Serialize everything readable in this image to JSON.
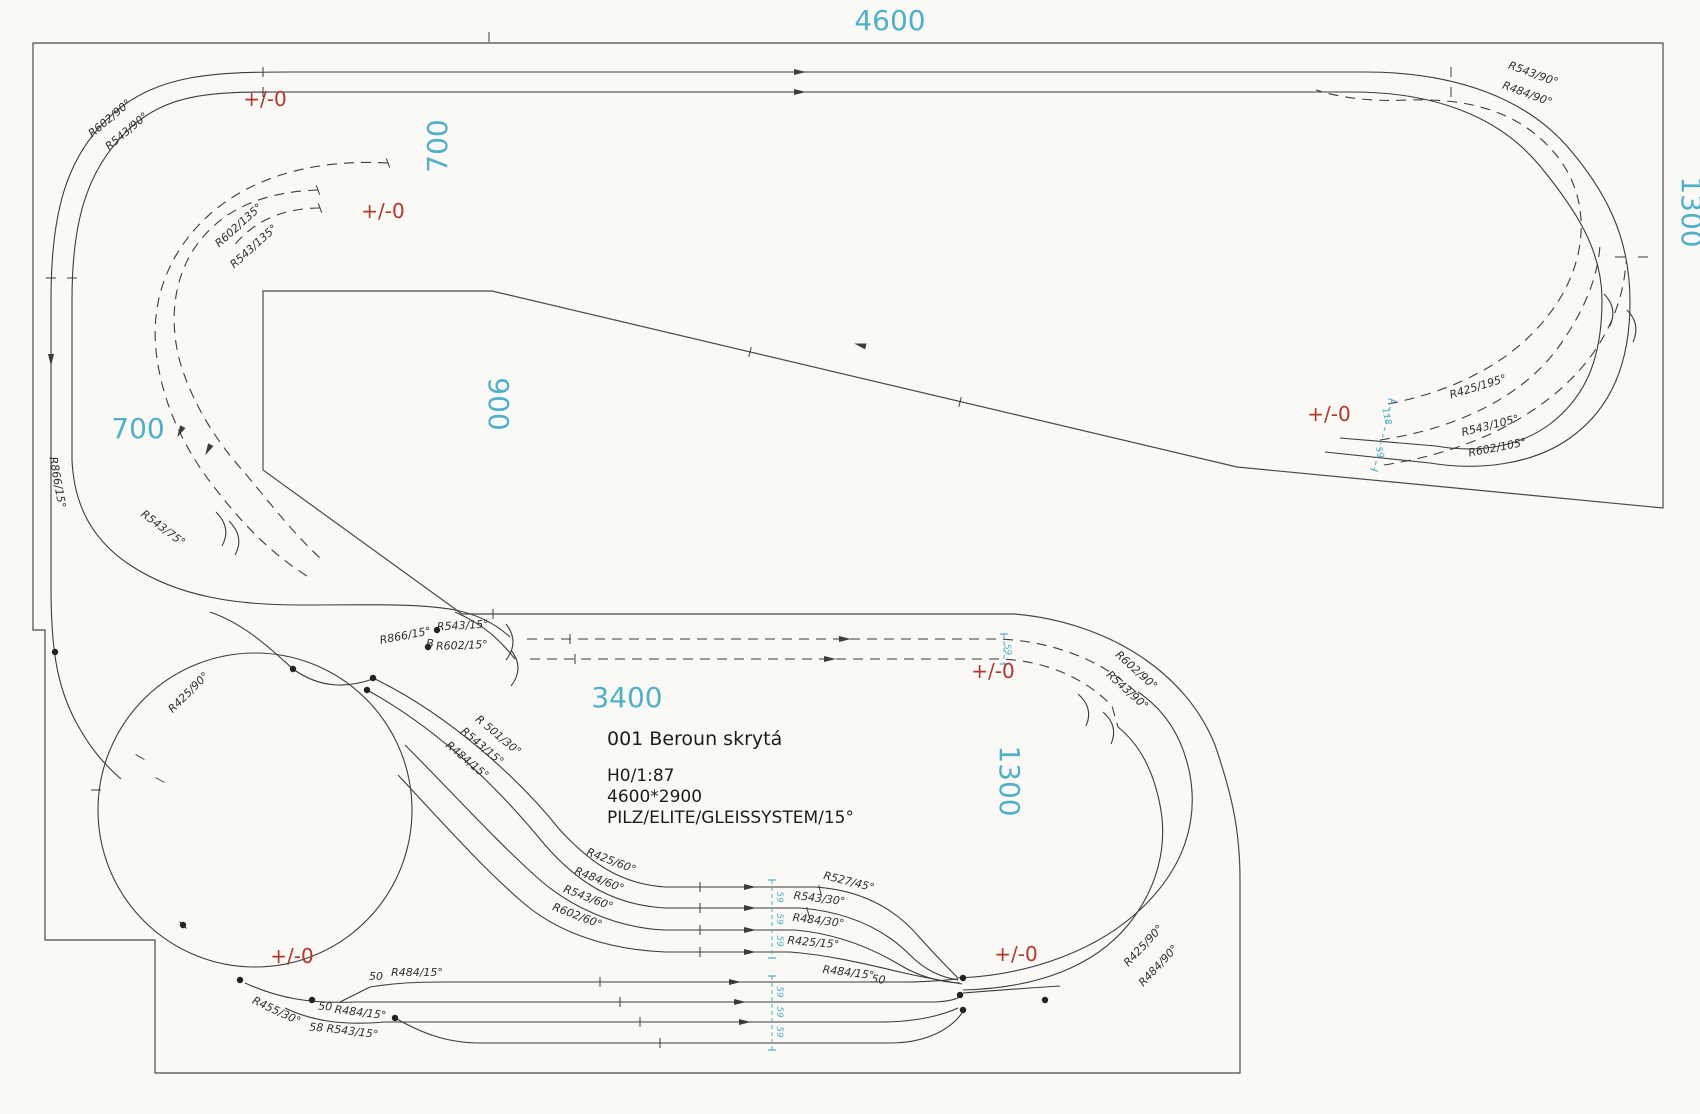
{
  "colors": {
    "paper": "#fbf9f5",
    "ink": "#3c3c3c",
    "teal": "#4fb0c8",
    "red": "#b1372a"
  },
  "title_block": {
    "line1": "001 Beroun skrytá",
    "line2": "H0/1:87",
    "line3": "4600*2900",
    "line4": "PILZ/ELITE/GLEISSYSTEM/15°"
  },
  "dimensions": [
    {
      "t": "4600",
      "x": 890,
      "y": 30,
      "r": 0
    },
    {
      "t": "1300",
      "x": 1682,
      "y": 212,
      "r": 90
    },
    {
      "t": "700",
      "x": 447,
      "y": 146,
      "r": -90
    },
    {
      "t": "700",
      "x": 138,
      "y": 438,
      "r": 0
    },
    {
      "t": "900",
      "x": 489,
      "y": 404,
      "r": 90
    },
    {
      "t": "3400",
      "x": 627,
      "y": 707,
      "r": 0
    },
    {
      "t": "1300",
      "x": 1000,
      "y": 781,
      "r": 90
    }
  ],
  "elevation_marks": [
    {
      "t": "+/-0",
      "x": 265,
      "y": 106
    },
    {
      "t": "+/-0",
      "x": 383,
      "y": 218
    },
    {
      "t": "+/-0",
      "x": 1329,
      "y": 421
    },
    {
      "t": "+/-0",
      "x": 993,
      "y": 678
    },
    {
      "t": "+/-0",
      "x": 292,
      "y": 963
    },
    {
      "t": "+/-0",
      "x": 1016,
      "y": 961
    }
  ],
  "track_labels": [
    {
      "t": "R602/90°",
      "x": 112,
      "y": 121,
      "r": -40
    },
    {
      "t": "R543/90°",
      "x": 129,
      "y": 134,
      "r": -40
    },
    {
      "t": "R602/135°",
      "x": 241,
      "y": 228,
      "r": -42
    },
    {
      "t": "R543/135°",
      "x": 256,
      "y": 249,
      "r": -42
    },
    {
      "t": "R543/90°",
      "x": 1532,
      "y": 77,
      "r": 20
    },
    {
      "t": "R484/90°",
      "x": 1526,
      "y": 97,
      "r": 20
    },
    {
      "t": "R425/195°",
      "x": 1479,
      "y": 390,
      "r": -17
    },
    {
      "t": "R543/105°",
      "x": 1491,
      "y": 429,
      "r": -14
    },
    {
      "t": "R602/105°",
      "x": 1498,
      "y": 451,
      "r": -11
    },
    {
      "t": "R866/15°",
      "x": 54,
      "y": 483,
      "r": 80
    },
    {
      "t": "R543/75°",
      "x": 161,
      "y": 531,
      "r": 37
    },
    {
      "t": "R543/15°",
      "x": 463,
      "y": 629,
      "r": -3
    },
    {
      "t": "R866/15°",
      "x": 406,
      "y": 639,
      "r": -11
    },
    {
      "t": "B",
      "x": 430,
      "y": 647,
      "r": 0
    },
    {
      "t": "R602/15°",
      "x": 462,
      "y": 649,
      "r": -2
    },
    {
      "t": "R602/90°",
      "x": 1134,
      "y": 673,
      "r": 42
    },
    {
      "t": "R543/90°",
      "x": 1125,
      "y": 693,
      "r": 42
    },
    {
      "t": "R425/90°",
      "x": 191,
      "y": 695,
      "r": -45
    },
    {
      "t": "R 501/30°",
      "x": 496,
      "y": 738,
      "r": 40
    },
    {
      "t": "R543/15°",
      "x": 480,
      "y": 749,
      "r": 40
    },
    {
      "t": "R484/15°",
      "x": 465,
      "y": 763,
      "r": 40
    },
    {
      "t": "R425/60°",
      "x": 610,
      "y": 864,
      "r": 21
    },
    {
      "t": "R484/60°",
      "x": 598,
      "y": 883,
      "r": 21
    },
    {
      "t": "R543/60°",
      "x": 587,
      "y": 901,
      "r": 21
    },
    {
      "t": "R602/60°",
      "x": 576,
      "y": 919,
      "r": 21
    },
    {
      "t": "R527/45°",
      "x": 848,
      "y": 885,
      "r": 14
    },
    {
      "t": "R543/30°",
      "x": 819,
      "y": 902,
      "r": 7
    },
    {
      "t": "R484/30°",
      "x": 818,
      "y": 924,
      "r": 7
    },
    {
      "t": "R425/15°",
      "x": 813,
      "y": 946,
      "r": 5
    },
    {
      "t": "R484/15°",
      "x": 848,
      "y": 976,
      "r": 7
    },
    {
      "t": "50",
      "x": 878,
      "y": 983,
      "r": 7
    },
    {
      "t": "50",
      "x": 376,
      "y": 980,
      "r": 0
    },
    {
      "t": "R484/15°",
      "x": 417,
      "y": 976,
      "r": 0
    },
    {
      "t": "R455/30°",
      "x": 275,
      "y": 1014,
      "r": 25
    },
    {
      "t": "50",
      "x": 325,
      "y": 1010,
      "r": 4
    },
    {
      "t": "R484/15°",
      "x": 360,
      "y": 1016,
      "r": 7
    },
    {
      "t": "58",
      "x": 316,
      "y": 1031,
      "r": 4
    },
    {
      "t": "R543/15°",
      "x": 352,
      "y": 1035,
      "r": 7
    },
    {
      "t": "R425/90°",
      "x": 1146,
      "y": 948,
      "r": -47
    },
    {
      "t": "R484/90°",
      "x": 1161,
      "y": 968,
      "r": -47
    }
  ],
  "spacing_marks": [
    {
      "t": "118",
      "x": 1384,
      "y": 417,
      "r": 77
    },
    {
      "t": "59",
      "x": 1377,
      "y": 453,
      "r": 77
    },
    {
      "t": "59",
      "x": 1005,
      "y": 650,
      "r": 83
    },
    {
      "t": "59",
      "x": 777,
      "y": 897,
      "r": 90
    },
    {
      "t": "59",
      "x": 777,
      "y": 919,
      "r": 90
    },
    {
      "t": "59",
      "x": 777,
      "y": 941,
      "r": 90
    },
    {
      "t": "59",
      "x": 777,
      "y": 992,
      "r": 90
    },
    {
      "t": "59",
      "x": 777,
      "y": 1012,
      "r": 90
    },
    {
      "t": "59",
      "x": 777,
      "y": 1032,
      "r": 90
    }
  ]
}
